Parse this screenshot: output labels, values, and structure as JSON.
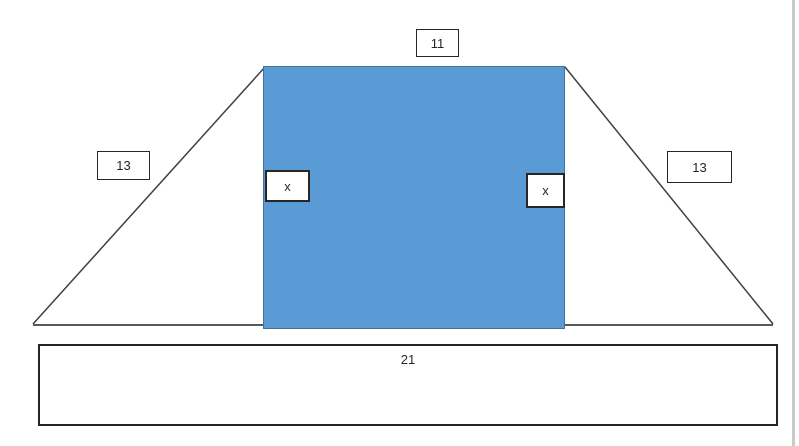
{
  "diagram": {
    "type": "geometry-trapezoid-decomposition",
    "labels": {
      "top": "11",
      "left_slant": "13",
      "right_slant": "13",
      "left_height": "x",
      "right_height": "x",
      "base": "21"
    },
    "colors": {
      "rectangle_fill": "#5B9BD5",
      "rectangle_stroke": "#41719C",
      "slant_line": "#404040",
      "base_line": "#595959",
      "label_border": "#262626",
      "page_edge": "#C9C9C9"
    }
  }
}
